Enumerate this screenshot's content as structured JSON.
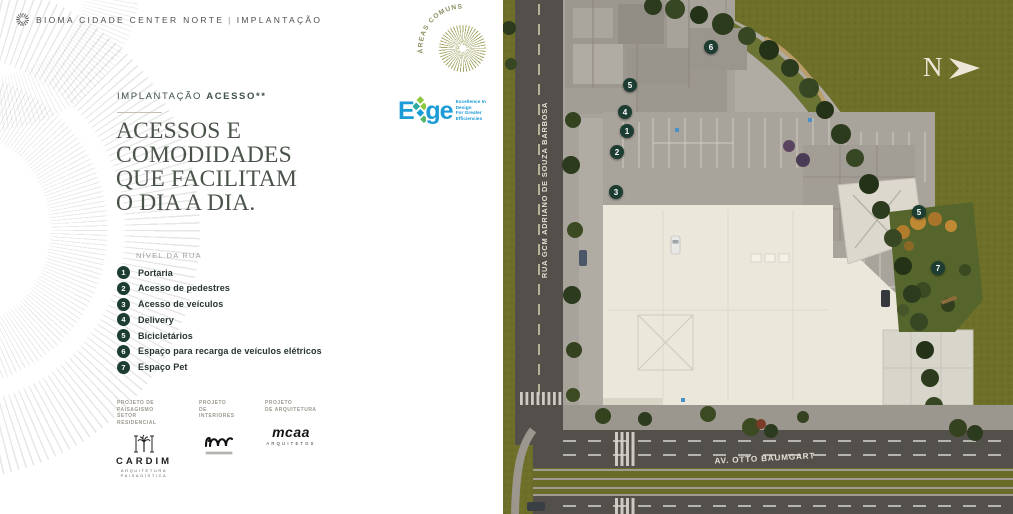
{
  "header": {
    "brand": "BIOMA CIDADE CENTER NORTE",
    "separator": "|",
    "section": "IMPLANTAÇÃO"
  },
  "badge": {
    "text": "ÁREAS COMUNS ENTREGUES EQUIPADAS E DECORADAS* · "
  },
  "intro": {
    "kicker_light": "IMPLANTAÇÃO ",
    "kicker_bold": "ACESSO**",
    "title_lines": [
      "ACESSOS E",
      "COMODIDADES",
      "QUE FACILITAM",
      "O DIA A DIA."
    ]
  },
  "edge": {
    "word_start": "E",
    "word_end": "ge",
    "tagline_line1": "Excellence In Design",
    "tagline_line2": "For Greater Efficiencies",
    "superscript": "1"
  },
  "legend": {
    "group_label": "NÍVEL DA RUA",
    "items": [
      {
        "num": "1",
        "label": "Portaria"
      },
      {
        "num": "2",
        "label": "Acesso de pedestres"
      },
      {
        "num": "3",
        "label": "Acesso de veículos"
      },
      {
        "num": "4",
        "label": "Delivery"
      },
      {
        "num": "5",
        "label": "Bicicletários"
      },
      {
        "num": "6",
        "label": "Espaço para recarga de veículos elétricos"
      },
      {
        "num": "7",
        "label": "Espaço Pet"
      }
    ]
  },
  "credits": {
    "col1": {
      "label_line1": "PROJETO DE PAISAGISMO",
      "label_line2": "SETOR RESIDENCIAL",
      "logo": "CARDIM",
      "sub_line1": "ARQUITETURA",
      "sub_line2": "PAISAGÍSTICA"
    },
    "col2": {
      "label_line1": "PROJETO",
      "label_line2": "DE INTERIORES"
    },
    "col3": {
      "label_line1": "PROJETO",
      "label_line2": "DE ARQUITETURA",
      "logo": "mcaa",
      "sub": "ARQUITETOS"
    }
  },
  "map": {
    "street_left": "RUA GCM ADRIANO DE SOUZA BARBOSA",
    "street_bottom": "AV. OTTO BAUMGART",
    "compass": "N",
    "markers": [
      {
        "n": "6"
      },
      {
        "n": "5"
      },
      {
        "n": "4"
      },
      {
        "n": "1"
      },
      {
        "n": "2"
      },
      {
        "n": "3"
      },
      {
        "n": "5"
      },
      {
        "n": "7"
      }
    ]
  },
  "colors": {
    "marker_green": "#1d3d33",
    "edge_blue": "#1b9bd7",
    "grass_olive": "#6e7029",
    "road_gray": "#53504b",
    "roof_cream": "#ebe7da",
    "heading_green": "#4a5349",
    "badge_olive": "#a5a566"
  }
}
